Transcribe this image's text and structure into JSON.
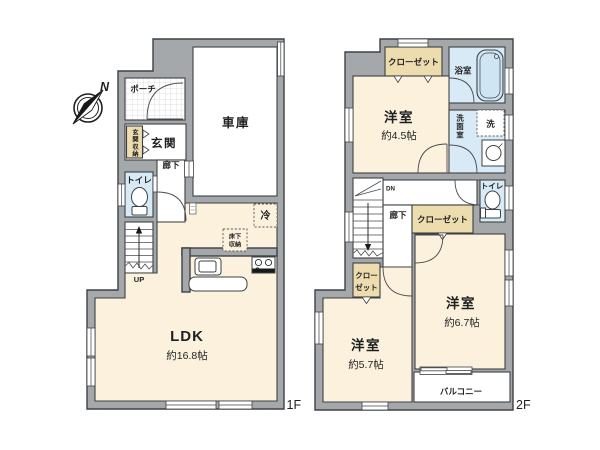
{
  "floor1": {
    "floor_label": "1F",
    "porch": "ポーチ",
    "entrance": "玄関",
    "entrance_storage": "玄関収納",
    "hallway": "廊下",
    "toilet": "トイレ",
    "garage": "車庫",
    "fridge": "冷",
    "underfloor_storage_line1": "床下",
    "underfloor_storage_line2": "収納",
    "ldk": "LDK",
    "ldk_size": "約16.8帖",
    "stairs_up": "UP"
  },
  "floor2": {
    "floor_label": "2F",
    "closet_top": "クローゼット",
    "bathroom": "浴室",
    "bedroom_a": "洋室",
    "bedroom_a_size": "約4.5帖",
    "washroom": "洗面室",
    "washer": "洗",
    "toilet": "トイレ",
    "stairs_down": "DN",
    "hallway": "廊下",
    "closet_hall": "クローゼット",
    "closet_small_line1": "クロー",
    "closet_small_line2": "ゼット",
    "bedroom_b": "洋室",
    "bedroom_b_size": "約6.7帖",
    "bedroom_c": "洋室",
    "bedroom_c_size": "約5.7帖",
    "balcony": "バルコニー"
  },
  "compass": {
    "north_label": "N"
  },
  "colors": {
    "wall": "#a5a8ab",
    "outline": "#3e4144",
    "room_cream": "#fbf1dd",
    "water_blue": "#d8eaf6",
    "closet_beige": "#ecdcae",
    "bathtub_blue": "#d0e5f3"
  }
}
